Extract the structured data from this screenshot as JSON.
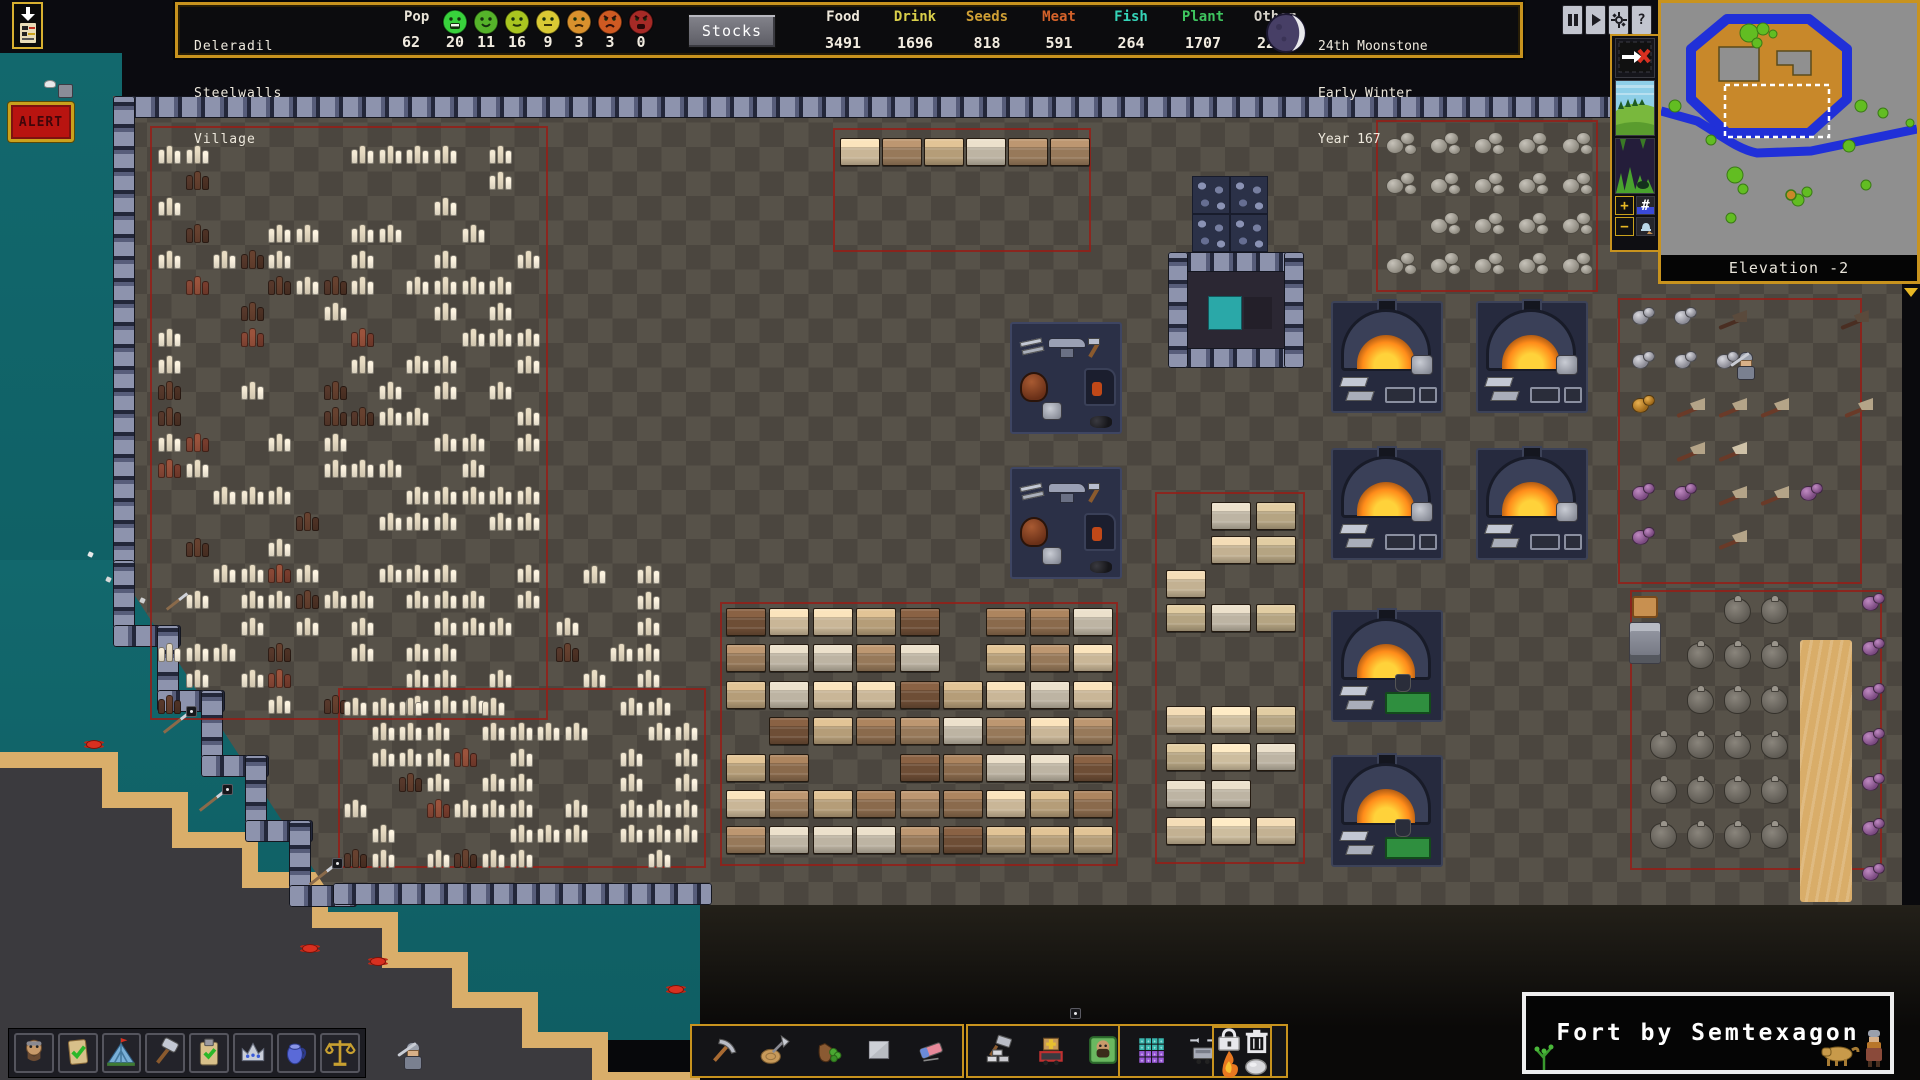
{
  "colors": {
    "gold_border": "#c8931e",
    "water": "#12686d",
    "floor_dark": "#4b463f",
    "floor_light": "#575249",
    "stockpile_border": "#941e18",
    "alert_red": "#b81410"
  },
  "header": {
    "fort_name_lines": [
      "Deleradil",
      "Steelwalls",
      "Village"
    ],
    "pop_label": "Pop",
    "pop_total": "62",
    "moods": [
      {
        "type": "ecstatic",
        "color": "#38d23c",
        "count": "20"
      },
      {
        "type": "happy",
        "color": "#55b32a",
        "count": "11"
      },
      {
        "type": "content",
        "color": "#a9c520",
        "count": "16"
      },
      {
        "type": "fine",
        "color": "#d9c934",
        "count": "9"
      },
      {
        "type": "unhappy",
        "color": "#d9912d",
        "count": "3"
      },
      {
        "type": "angry",
        "color": "#cf5a22",
        "count": "3"
      },
      {
        "type": "miserable",
        "color": "#a62a26",
        "count": "0"
      }
    ],
    "stocks_button": "Stocks",
    "resources": [
      {
        "label": "Food",
        "value": "3491",
        "color": "#efe9dc"
      },
      {
        "label": "Drink",
        "value": "1696",
        "color": "#d9cf4a"
      },
      {
        "label": "Seeds",
        "value": "818",
        "color": "#cf9f35"
      },
      {
        "label": "Meat",
        "value": "591",
        "color": "#d4622a"
      },
      {
        "label": "Fish",
        "value": "264",
        "color": "#35d4b8"
      },
      {
        "label": "Plant",
        "value": "1707",
        "color": "#3fc45f"
      },
      {
        "label": "Other",
        "value": "2214",
        "color": "#d6d2c9"
      }
    ],
    "date_lines": [
      "24th Moonstone",
      "Early Winter",
      "Year 167"
    ],
    "moon_icon": "moon-phase-icon"
  },
  "controls": {
    "pause_icon": "pause-icon",
    "play_icon": "play-icon",
    "settings_icon": "gear-icon",
    "help_label": "?"
  },
  "side_controls": {
    "follow_icon": "follow-cancel-icon",
    "surface_icon": "surface-view-icon",
    "cavern_icon": "cavern-view-icon",
    "plus_glyph": "+",
    "hash_glyph": "#",
    "minus_glyph": "−",
    "bell_icon": "bell-icon"
  },
  "minimap": {
    "elevation_label": "Elevation -2"
  },
  "alert": {
    "label": "ALERT"
  },
  "announce": {
    "icon": "announcements-icon"
  },
  "toolbar_left": {
    "buttons": [
      "citizens",
      "tasks",
      "places",
      "labor",
      "work-orders",
      "nobles",
      "objects",
      "justice"
    ]
  },
  "toolbar_center": {
    "groups": [
      [
        "dig",
        "chop",
        "gather",
        "smooth",
        "erase"
      ],
      [
        "build",
        "stockpile",
        "zones"
      ],
      [
        "traffic",
        "routes",
        "more"
      ]
    ],
    "more_glyph": "»"
  },
  "mini_panel": {
    "buttons": [
      "forbid",
      "dump",
      "melt",
      "stone"
    ]
  },
  "banner": {
    "text": "Fort by Semtexagon"
  }
}
